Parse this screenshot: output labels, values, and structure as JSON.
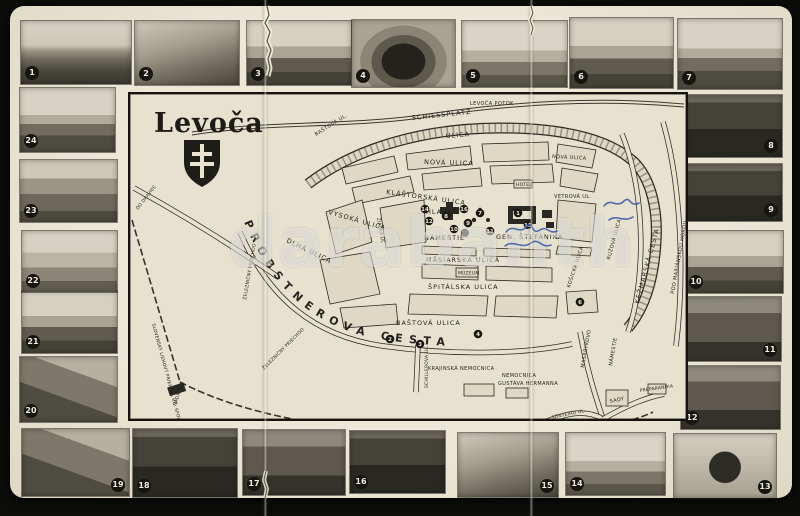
{
  "card": {
    "kind": "vintage fold-out postcard map of Levoča with photo vignettes",
    "paper_color": "#ebe6d5",
    "ink_color": "#26241e",
    "watermark": "darabanth",
    "handwriting_color": "#3b57a5"
  },
  "map": {
    "title": "Levoča",
    "labels": {
      "levoca_potok": "LEVOČA POTOK",
      "schiessplatz": "SCHIESSPLATZ",
      "schiessplatz_ulica": "ULICA",
      "bastova_top": "BAŠTOVÁ UL.",
      "nova": "NOVÁ ULICA",
      "klastorska": "KLÁŠTORSKÁ ULICA",
      "vysoka": "VYSOKÁ ULICA",
      "ziacka": "ŽIACKA UL.",
      "dlha": "DLHÁ ULICA",
      "hlavne": "HLAVNÉ",
      "namestie": "NÁMESTIE",
      "stefanika": "GEN. ŠTEFÁNIKA",
      "masiarska": "MÄSIARSKA ULICA",
      "muzeum": "MÚZEUM",
      "spitalska": "ŠPITÁLSKA ULICA",
      "bastova_south": "BAŠTOVÁ ULICA",
      "probstnerova": "PROBSTNEROVA CESTA",
      "kosicka": "KOŠICKÁ ULICA",
      "ruzova": "RUŽOVÁ ULICA",
      "vetrova": "VETROVÁ UL.",
      "kezmarska": "KEŽMARSKÁ CESTA",
      "pod_marianskou": "POD MARIÁNSKOU HOROU",
      "masarykovo": "MASARYKOVO",
      "masarykovo_nam": "NÁMESTIE",
      "sady": "SADY",
      "sonyeiho": "SÖNYEIHO UL.",
      "preparandia": "PREPARANDIA",
      "schillerova": "SCHILLEROVA UL.",
      "krajinska_nemocnica": "KRAJINSKÁ NEMOCNICA",
      "nemocnica": "NEMOCNICA",
      "gustava_hermanna": "GUSTÁVA HERMANNA",
      "nadrazie": "NÁDRAŽIE",
      "liehovar": "SLOVENSKÝ LIEHOVÝ PRIEMYSL ÚČ. SPOL.",
      "zeleznicny_priechod": "ŽELEZNIČNÝ PRIECHOD",
      "do_draviec": "DO DRAVIEC",
      "hotel": "HOTEL"
    },
    "badges": [
      "1",
      "7",
      "8",
      "9",
      "10",
      "11",
      "12",
      "14",
      "15",
      "16",
      "2",
      "3",
      "4",
      "6"
    ]
  },
  "photos": [
    {
      "number": "1",
      "subject": "town-panorama"
    },
    {
      "number": "2",
      "subject": "town-walls-ruins"
    },
    {
      "number": "3",
      "subject": "building-with-wall"
    },
    {
      "number": "4",
      "subject": "lourdes-grotto"
    },
    {
      "number": "5",
      "subject": "church-with-monument"
    },
    {
      "number": "6",
      "subject": "manor-house"
    },
    {
      "number": "7",
      "subject": "st-james-church"
    },
    {
      "number": "8",
      "subject": "church-interior"
    },
    {
      "number": "9",
      "subject": "altar-detail"
    },
    {
      "number": "10",
      "subject": "town-hall"
    },
    {
      "number": "11",
      "subject": "arcade-passage"
    },
    {
      "number": "12",
      "subject": "guild-hall-interior"
    },
    {
      "number": "13",
      "subject": "cage-of-shame"
    },
    {
      "number": "14",
      "subject": "street-view-churches"
    },
    {
      "number": "15",
      "subject": "carved-altar"
    },
    {
      "number": "16",
      "subject": "main-altar"
    },
    {
      "number": "17",
      "subject": "chapel-interior"
    },
    {
      "number": "18",
      "subject": "monastery-corridor"
    },
    {
      "number": "19",
      "subject": "church-portal"
    },
    {
      "number": "20",
      "subject": "courtyard-staircase"
    },
    {
      "number": "21",
      "subject": "spa-building"
    },
    {
      "number": "22",
      "subject": "marianska-hora"
    },
    {
      "number": "23",
      "subject": "town-park"
    },
    {
      "number": "24",
      "subject": "spis-castle"
    }
  ]
}
